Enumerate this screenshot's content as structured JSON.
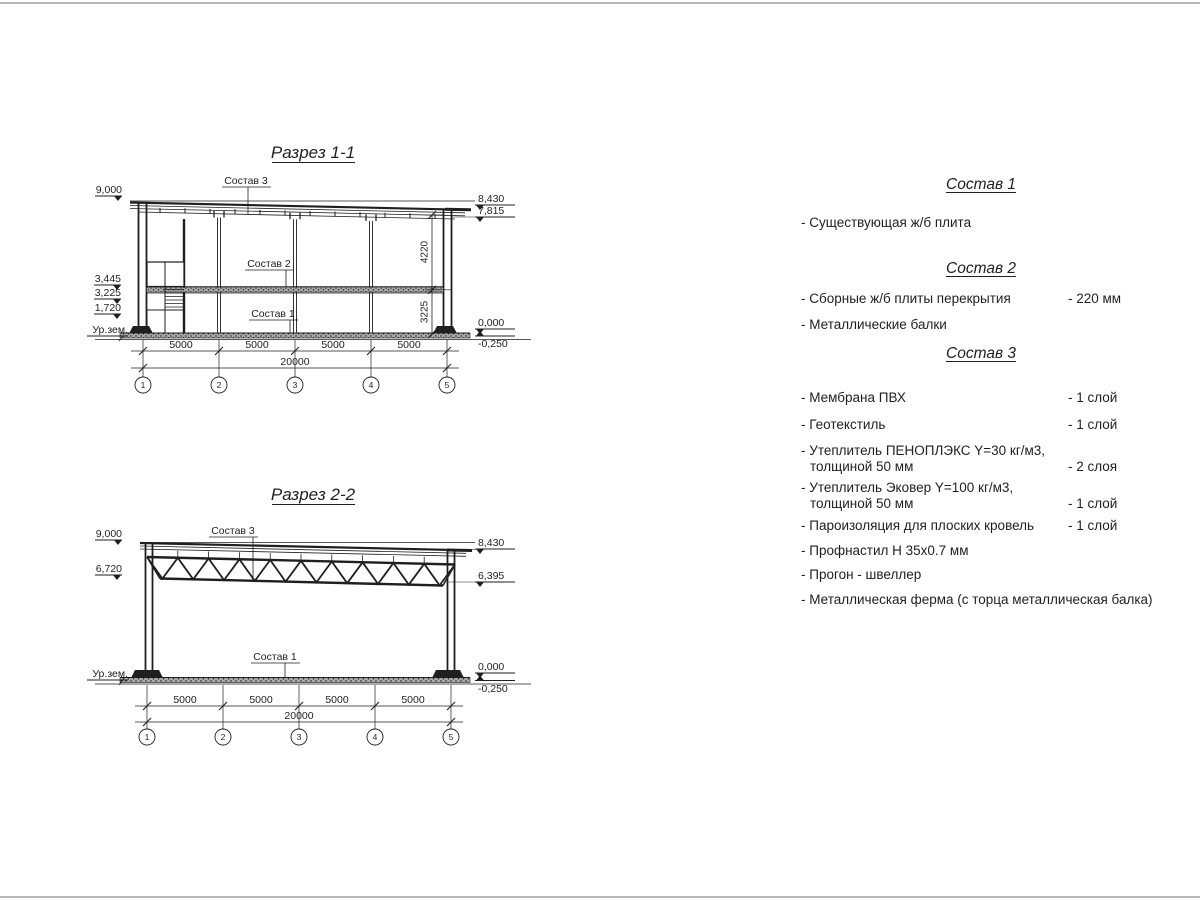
{
  "sections": {
    "s1": {
      "title": "Разрез 1-1",
      "callouts": [
        "Состав 3",
        "Состав 2",
        "Состав 1"
      ],
      "marks_left": [
        "9,000",
        "3,445",
        "3,225",
        "1,720",
        "Ур.зем."
      ],
      "marks_right": [
        "8,430",
        "7,815",
        "0,000",
        "-0,250"
      ],
      "dims_vertical": [
        "4220",
        "3225"
      ],
      "dims_bay": [
        "5000",
        "5000",
        "5000",
        "5000"
      ],
      "dim_total": "20000",
      "axes": [
        "1",
        "2",
        "3",
        "4",
        "5"
      ]
    },
    "s2": {
      "title": "Разрез 2-2",
      "callouts": [
        "Состав 3",
        "Состав 1"
      ],
      "marks_left": [
        "9,000",
        "6,720",
        "Ур.зем."
      ],
      "marks_right": [
        "8,430",
        "6,395",
        "0,000",
        "-0,250"
      ],
      "dims_bay": [
        "5000",
        "5000",
        "5000",
        "5000"
      ],
      "dim_total": "20000",
      "axes": [
        "1",
        "2",
        "3",
        "4",
        "5"
      ]
    }
  },
  "compositions": {
    "c1": {
      "title": "Состав 1",
      "items": [
        {
          "line1": "- Существующая ж/б плита",
          "qty": ""
        }
      ]
    },
    "c2": {
      "title": "Состав 2",
      "items": [
        {
          "line1": "- Сборные ж/б плиты перекрытия",
          "qty": "- 220 мм"
        },
        {
          "line1": "- Металлические балки",
          "qty": ""
        }
      ]
    },
    "c3": {
      "title": "Состав 3",
      "items": [
        {
          "line1": "- Мембрана ПВХ",
          "qty": "- 1 слой"
        },
        {
          "line1": "- Геотекстиль",
          "qty": "- 1 слой"
        },
        {
          "line1": "- Утеплитель ПЕНОПЛЭКС Y=30 кг/м3,",
          "line2": "толщиной 50 мм",
          "qty": "- 2 слоя"
        },
        {
          "line1": "- Утеплитель Эковер Y=100 кг/м3,",
          "line2": "толщиной 50 мм",
          "qty": "- 1 слой"
        },
        {
          "line1": "- Пароизоляция для плоских кровель",
          "qty": "- 1 слой"
        },
        {
          "line1": "- Профнастил Н 35х0.7 мм",
          "qty": ""
        },
        {
          "line1": "- Прогон - швеллер",
          "qty": ""
        },
        {
          "line1": "- Металлическая ферма (с торца металлическая балка)",
          "qty": ""
        }
      ]
    }
  },
  "colors": {
    "ink": "#1f1f1f",
    "paper": "#ffffff"
  }
}
